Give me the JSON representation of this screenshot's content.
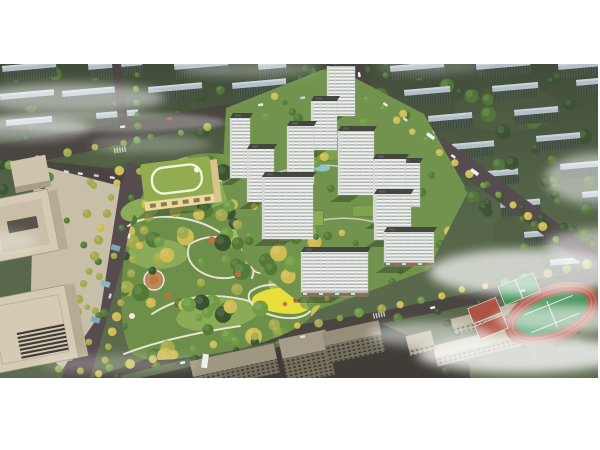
{
  "meta": {
    "subject": "Aerial 3D architectural rendering of a residential masterplan: white high-rise towers around a central tree-filled park, kindergarten with green roof, tree-lined boulevard, office towers at left, school with running track and courts at lower right, rows of existing housing blocks behind, drifting fog",
    "canvas": {
      "w": 600,
      "h": 450
    },
    "image_area": {
      "x": 0,
      "y": 64,
      "w": 600,
      "h": 314
    }
  },
  "palette": {
    "frame": "#ffffff",
    "ground_top": "#414d3a",
    "ground_mid": "#566549",
    "ground_low": "#5d6b4e",
    "mottle_dark": "#3c4936",
    "mottle_light": "#66754f",
    "park": "#6e8f49",
    "lawn": "#8aab57",
    "lawn_bright": "#9cbd62",
    "court_ground": "#72934e",
    "road": "#4a4541",
    "road_warm": "#564b4e",
    "pavement": "#403c38",
    "path": "#ece9dc",
    "court_path": "#d9d3be",
    "tower_face": "#f2f3f0",
    "tower_window": "#a9b0ad",
    "tower_edge": "#d7dad4",
    "tower_roof": "#43473f",
    "tower_roof_unit": "#5a5e55",
    "shadow": "#26301f",
    "slab_top": "#b2c0ca",
    "slab_face": "#4d5a4b",
    "slab_stripe": "#3c4639",
    "tree_dark": "#3b5430",
    "tree_mid": "#547b36",
    "tree_light": "#6f9c44",
    "tree_yellow": "#cdbd54",
    "tree_olive": "#a2aa4e",
    "accent_orange": "#c2703a",
    "kinder_roof": "#92ad4f",
    "kinder_wall": "#ecd9a0",
    "kinder_side": "#d9c489",
    "kinder_loop": "#f4f1dd",
    "pavilion": "#7ea34e",
    "pavilion2": "#8aad52",
    "pool": "#8fc3cd",
    "office_beige": "#d5cbb4",
    "office_inner": "#c9bfa8",
    "office_side": "#b6ac93",
    "office_slot": "#57534a",
    "office_slat": "#413d36",
    "plaza": "#c8bfa9",
    "city_roof_a": "#9f977f",
    "city_roof_b": "#a59d8a",
    "city_roof_c": "#968e7b",
    "city_face": "#77715f",
    "city_window": "#3e3a33",
    "school_roof_a": "#c0b7a1",
    "school_roof_b": "#b8af9a",
    "school_face": "#a49b85",
    "school_window": "#4a453c",
    "track_red": "#a85a4a",
    "track_lane": "#c9837a",
    "field_green": "#3f8f54",
    "court_red": "#ad5244",
    "line_white": "#e8e8e4",
    "playground": "#e6df3c",
    "canopy_blue": "#7fa9b8",
    "canopy_blue2": "#8fb3c0",
    "retail_base": "#7b7468",
    "retail_awning": "#c8574a",
    "cloud": "#ffffff",
    "truck": "#eef0ee"
  },
  "render": {
    "roads": {
      "A": "M0,80 L366,16 L366,28 L0,106 Z",
      "B": "M352,0 L364,0 L372,27 L357,29 Z",
      "C": "M361,16 L375,24 L602,192 L602,215 L354,30 Z",
      "D": "M92,314 L196,278 L382,247 L602,202 L602,214 L390,258 L206,290 L112,314 Z",
      "F": "M112,0 L121,0 L131,82 L121,85 Z",
      "boulevard": "M128,99 L150,103 L90,314 L62,314 Z",
      "parking": "M44,97 L150,109 L146,141 L51,129 Z",
      "pavement": "M140,314 L382,260 L470,300 L470,314 Z"
    },
    "park": {
      "blob": "M130,288 C118,262 118,208 132,156 C142,126 156,104 176,96 C198,88 218,86 242,96 C264,104 274,126 284,148 C302,152 318,164 326,182 C336,204 332,234 310,254 C286,276 234,288 192,293 C162,297 140,298 130,288 Z",
      "lawns": [
        [
          200,
          128,
          40,
          18,
          -10,
          "lawn"
        ],
        [
          158,
          190,
          30,
          15,
          0,
          "lawn"
        ],
        [
          252,
          168,
          28,
          13,
          -6,
          "lawn_bright"
        ],
        [
          218,
          250,
          42,
          16,
          -8,
          "lawn"
        ],
        [
          292,
          220,
          24,
          11,
          0,
          "lawn_bright"
        ],
        [
          140,
          146,
          20,
          11,
          -15,
          "lawn"
        ]
      ],
      "paths": [
        "M152,120 C192,108 240,112 262,140",
        "M128,162 C152,147 192,152 216,166 C246,183 258,200 252,214",
        "M152,250 C182,230 220,228 252,238 C280,246 296,240 300,224",
        "M190,180 C210,168 235,172 244,188 C252,204 240,216 220,214 C198,212 182,196 190,180 Z",
        "M124,290 C160,276 200,268 240,262",
        "M250,228 C262,218 290,218 306,228 C318,238 314,252 294,254 C270,256 242,240 250,228 Z",
        "M262,140 C270,150 272,160 268,172",
        "M324,182 C302,184 286,192 274,202"
      ],
      "playground": "M254,232 C266,222 292,221 306,230 C317,238 310,250 292,250 C270,250 245,241 254,232 Z",
      "plazas": [
        [
          260,
          200,
          9
        ],
        [
          154,
          216,
          10
        ]
      ]
    },
    "courtyard": {
      "blob": "M226,44 L332,2 L424,50 L468,128 L428,206 L312,248 L246,198 L222,120 Z",
      "paths": [
        "M250,120 C290,100 330,95 370,110",
        "M280,170 C320,150 360,150 395,165",
        "M330,60 C345,80 350,100 345,120"
      ],
      "pavilions": [
        [
          316,
          84,
          26,
          13,
          "pavilion"
        ],
        [
          293,
          148,
          30,
          15,
          "pavilion2"
        ],
        [
          352,
          142,
          24,
          11,
          "pavilion"
        ],
        [
          278,
          164,
          38,
          14,
          "pavilion2"
        ]
      ],
      "pool": [
        322,
        104,
        8,
        3.5
      ]
    },
    "towers": [
      {
        "x": 230,
        "y": 54,
        "w": 20,
        "h": 60
      },
      {
        "x": 247,
        "y": 85,
        "w": 27,
        "h": 53
      },
      {
        "x": 287,
        "y": 62,
        "w": 27,
        "h": 58
      },
      {
        "x": 311,
        "y": 37,
        "w": 26,
        "h": 49
      },
      {
        "x": 327,
        "y": 2,
        "w": 28,
        "h": 50
      },
      {
        "x": 338,
        "y": 67,
        "w": 36,
        "h": 64
      },
      {
        "x": 373,
        "y": 95,
        "w": 33,
        "h": 63
      },
      {
        "x": 398,
        "y": 99,
        "w": 22,
        "h": 44
      },
      {
        "x": 262,
        "y": 113,
        "w": 51,
        "h": 62
      },
      {
        "x": 374,
        "y": 130,
        "w": 37,
        "h": 46
      },
      {
        "x": 301,
        "y": 188,
        "w": 67,
        "h": 44,
        "retail": true
      },
      {
        "x": 384,
        "y": 168,
        "w": 50,
        "h": 34,
        "retail": true
      }
    ],
    "slabs": [
      [
        2,
        2,
        54
      ],
      [
        88,
        0,
        54
      ],
      [
        174,
        0,
        54
      ],
      [
        258,
        0,
        28
      ],
      [
        0,
        30,
        54
      ],
      [
        62,
        27,
        54
      ],
      [
        148,
        23,
        54
      ],
      [
        232,
        19,
        54
      ],
      [
        6,
        56,
        46
      ],
      [
        96,
        49,
        42
      ],
      [
        390,
        2,
        54
      ],
      [
        476,
        0,
        54
      ],
      [
        558,
        0,
        40
      ],
      [
        404,
        26,
        46
      ],
      [
        492,
        22,
        46
      ],
      [
        576,
        16,
        24
      ],
      [
        428,
        52,
        44
      ],
      [
        514,
        46,
        44
      ],
      [
        452,
        80,
        42
      ],
      [
        536,
        72,
        44
      ],
      [
        476,
        108,
        42
      ],
      [
        560,
        100,
        40
      ],
      [
        500,
        138,
        40
      ],
      [
        582,
        128,
        18
      ],
      [
        524,
        168,
        38
      ],
      [
        548,
        196,
        36
      ]
    ],
    "regions": [
      {
        "x": 0,
        "y": 0,
        "w": 600,
        "h": 92,
        "n": 64,
        "colors": [
          "tree_dark",
          "tree_mid"
        ],
        "rmin": 3,
        "rmax": 8,
        "op": 0.85,
        "layer": "bg"
      },
      {
        "x": 470,
        "y": 92,
        "w": 130,
        "h": 66,
        "n": 20,
        "colors": [
          "tree_dark",
          "tree_mid"
        ],
        "rmin": 3,
        "rmax": 7,
        "op": 0.85,
        "layer": "fg"
      },
      {
        "x": 520,
        "y": 150,
        "w": 80,
        "h": 60,
        "n": 12,
        "colors": [
          "tree_dark",
          "tree_mid"
        ],
        "rmin": 3,
        "rmax": 6,
        "op": 0.8,
        "layer": "fg"
      },
      {
        "x": 440,
        "y": 250,
        "w": 160,
        "h": 60,
        "n": 16,
        "colors": [
          "tree_dark",
          "tree_mid"
        ],
        "rmin": 3,
        "rmax": 6,
        "op": 0.8,
        "layer": "fg"
      },
      {
        "x": 30,
        "y": 104,
        "w": 80,
        "h": 196,
        "n": 14,
        "colors": [
          "tree_olive",
          "tree_mid"
        ],
        "rmin": 2.5,
        "rmax": 4.5,
        "op": 1,
        "layer": "fg"
      },
      {
        "x": 0,
        "y": 92,
        "w": 50,
        "h": 40,
        "n": 8,
        "colors": [
          "tree_dark",
          "tree_mid"
        ],
        "rmin": 3,
        "rmax": 6,
        "op": 0.9,
        "layer": "fg"
      },
      {
        "x": 104,
        "y": 88,
        "w": 236,
        "h": 212,
        "n": 110,
        "colors": [
          "tree_mid",
          "tree_light",
          "tree_dark",
          "tree_yellow",
          "tree_olive"
        ],
        "rmin": 3.5,
        "rmax": 9,
        "op": 1,
        "clip": "parkClip",
        "layer": "fg"
      },
      {
        "x": 226,
        "y": 2,
        "w": 244,
        "h": 244,
        "n": 48,
        "colors": [
          "tree_light",
          "tree_yellow",
          "tree_mid"
        ],
        "rmin": 2.6,
        "rmax": 5,
        "op": 1,
        "clip": "courtClip",
        "layer": "fg"
      }
    ],
    "rows": [
      {
        "x1": 120,
        "y1": 106,
        "x2": 58,
        "y2": 306,
        "n": 15,
        "colors": [
          "tree_yellow",
          "tree_olive"
        ],
        "rmin": 3.2,
        "rmax": 5
      },
      {
        "x1": 160,
        "y1": 110,
        "x2": 100,
        "y2": 310,
        "n": 15,
        "colors": [
          "tree_yellow",
          "tree_olive"
        ],
        "rmin": 3.2,
        "rmax": 5
      },
      {
        "x1": 140,
        "y1": 106,
        "x2": 80,
        "y2": 308,
        "n": 8,
        "colors": [
          "tree_olive",
          "tree_mid"
        ],
        "rmin": 2.6,
        "rmax": 3.6
      },
      {
        "x1": 110,
        "y1": 303,
        "x2": 588,
        "y2": 200,
        "n": 24,
        "colors": [
          "tree_yellow",
          "tree_olive",
          "tree_light"
        ],
        "rmin": 3,
        "rmax": 5
      },
      {
        "x1": 116,
        "y1": 312,
        "x2": 560,
        "y2": 222,
        "n": 12,
        "colors": [
          "tree_mid",
          "tree_dark"
        ],
        "rmin": 3,
        "rmax": 4.5
      },
      {
        "x1": 368,
        "y1": 34,
        "x2": 556,
        "y2": 174,
        "n": 14,
        "colors": [
          "tree_yellow",
          "tree_light"
        ],
        "rmin": 3,
        "rmax": 4.6
      },
      {
        "x1": 10,
        "y1": 100,
        "x2": 350,
        "y2": 38,
        "n": 13,
        "colors": [
          "tree_mid",
          "tree_olive",
          "tree_light"
        ],
        "rmin": 2.8,
        "rmax": 4.4
      },
      {
        "x1": 136,
        "y1": 12,
        "x2": 138,
        "y2": 76,
        "n": 6,
        "colors": [
          "tree_mid",
          "tree_light"
        ],
        "rmin": 2.6,
        "rmax": 3.8
      }
    ],
    "accents": [
      [
        212,
        176,
        3.5
      ],
      [
        238,
        210,
        3
      ],
      [
        168,
        232,
        3
      ],
      [
        296,
        120,
        2.8
      ]
    ],
    "clouds": [
      [
        70,
        34,
        95,
        15,
        0.5,
        "b6"
      ],
      [
        20,
        64,
        70,
        12,
        0.45,
        "b6"
      ],
      [
        105,
        58,
        120,
        10,
        0.3,
        "b3"
      ],
      [
        150,
        80,
        60,
        9,
        0.28,
        "b6"
      ],
      [
        250,
        5,
        70,
        8,
        0.3,
        "b6"
      ],
      [
        430,
        2,
        55,
        7,
        0.25,
        "b6"
      ],
      [
        600,
        115,
        55,
        26,
        0.5,
        "b6"
      ],
      [
        524,
        208,
        95,
        23,
        0.7,
        "b6"
      ],
      [
        600,
        182,
        55,
        17,
        0.5,
        "b6"
      ],
      [
        522,
        290,
        105,
        19,
        0.78,
        "b6"
      ],
      [
        430,
        270,
        62,
        12,
        0.5,
        "b6"
      ],
      [
        565,
        255,
        70,
        14,
        0.6,
        "b6"
      ],
      [
        120,
        300,
        80,
        9,
        0.25,
        "b6"
      ],
      [
        0,
        178,
        38,
        11,
        0.3,
        "b6"
      ]
    ],
    "cars": [
      [
        120,
        62,
        -10,
        "#e9e9e9"
      ],
      [
        167,
        54,
        -10,
        "#c9463d"
      ],
      [
        258,
        40,
        -9,
        "#f1f1f1"
      ],
      [
        300,
        33,
        -9,
        "#cfd3d8"
      ],
      [
        360,
        8,
        80,
        "#f5f5f5"
      ],
      [
        384,
        38,
        36,
        "#f0f0f0"
      ],
      [
        404,
        53,
        36,
        "#dfe1e1"
      ],
      [
        452,
        90,
        36,
        "#f5f5f5"
      ],
      [
        131,
        170,
        108,
        "#e8e8e8"
      ],
      [
        112,
        230,
        108,
        "#d5dade"
      ],
      [
        180,
        298,
        -12,
        "#f0f0f0"
      ],
      [
        300,
        272,
        -12,
        "#e2e2e2"
      ],
      [
        430,
        243,
        -12,
        "#f6f6f6"
      ],
      [
        520,
        226,
        -12,
        "#d8d8d8"
      ],
      [
        64,
        106,
        10,
        "#dcdcdc"
      ],
      [
        78,
        108,
        10,
        "#e6e6e6"
      ],
      [
        94,
        110,
        10,
        "#cfcfcf"
      ],
      [
        110,
        112,
        10,
        "#e2e2e2"
      ]
    ],
    "buses": [
      [
        428,
        68,
        36
      ],
      [
        472,
        104,
        36
      ]
    ],
    "crosswalks": [
      [
        344,
        23,
        -9
      ],
      [
        361,
        33,
        36
      ],
      [
        379,
        251,
        -12
      ],
      [
        120,
        86,
        -8
      ]
    ],
    "canopies": [
      [
        112,
        180
      ],
      [
        102,
        216
      ],
      [
        92,
        252
      ]
    ],
    "kindergarten": {
      "x": 142,
      "y": 96,
      "w": 70,
      "hroof": 38,
      "hface": 9,
      "rot": -7
    },
    "city": [
      {
        "x": 192,
        "y": 288,
        "w": 86,
        "hr": 16,
        "hf": 14,
        "rot": -12,
        "roof": "city_roof_a"
      },
      {
        "x": 282,
        "y": 270,
        "w": 48,
        "hr": 20,
        "hf": 26,
        "rot": -12,
        "roof": "city_roof_b"
      },
      {
        "x": 324,
        "y": 262,
        "w": 58,
        "hr": 14,
        "hf": 18,
        "rot": -12,
        "roof": "city_roof_c"
      }
    ],
    "school": [
      {
        "x": 428,
        "y": 268,
        "w": 120,
        "hr": 12,
        "hf": 9,
        "rot": -14,
        "roof": "school_roof_a"
      },
      {
        "x": 452,
        "y": 246,
        "w": 96,
        "hr": 9,
        "hf": 7,
        "rot": -14,
        "roof": "school_roof_b"
      },
      {
        "x": 404,
        "y": 252,
        "w": 26,
        "hr": 14,
        "hf": 6,
        "rot": -14,
        "roof": "school_roof_b"
      }
    ]
  }
}
